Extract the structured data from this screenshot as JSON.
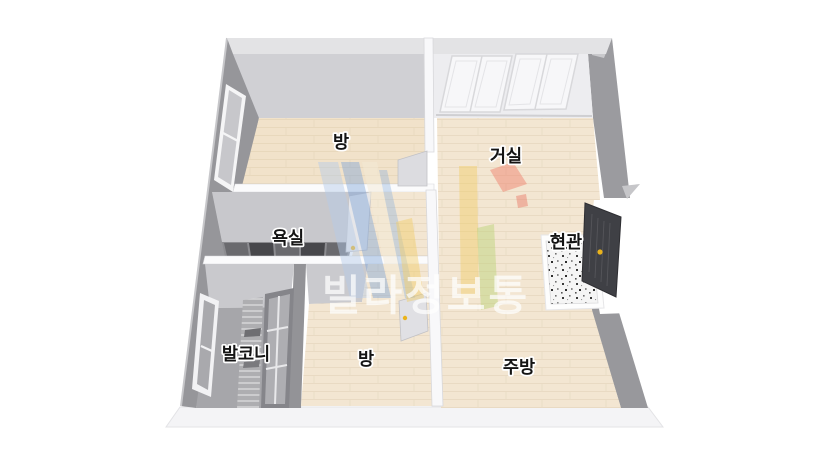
{
  "floorplan": {
    "rooms": {
      "room_top": {
        "label": "방"
      },
      "living_room": {
        "label": "거실"
      },
      "bathroom": {
        "label": "욕실"
      },
      "entrance": {
        "label": "현관"
      },
      "balcony": {
        "label": "발코니"
      },
      "room_bottom": {
        "label": "방"
      },
      "kitchen": {
        "label": "주방"
      }
    },
    "watermark": {
      "text": "빌라정보통"
    },
    "colors": {
      "floor_wood": "#f3e6d2",
      "wall_gray": "#9a9a9e",
      "wall_back_face": "#cfcfd3",
      "partition_white": "#fafafb",
      "balcony_floor": "#a7a7ab",
      "bath_tile": "#5f5f63",
      "entrance_door": "#3f4045",
      "door_handle": "#eab31c",
      "watermark_text": "#ffffff",
      "logo_light_blue": "#b5cbe8",
      "logo_blue": "#7aa2d8",
      "logo_cream": "#f1ead6",
      "logo_yellow": "#f2cb60",
      "logo_green": "#b9d276",
      "logo_red": "#ee8672"
    }
  }
}
